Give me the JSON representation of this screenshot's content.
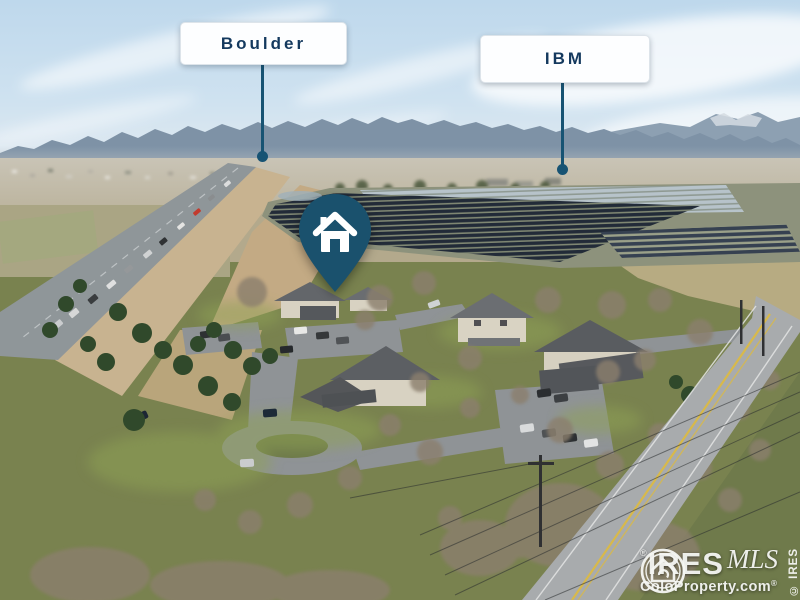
{
  "photo": {
    "callouts": [
      {
        "id": "boulder",
        "label": "Boulder"
      },
      {
        "id": "ibm",
        "label": "IBM"
      }
    ],
    "pin": {
      "icon": "house-icon",
      "color": "#1a516d"
    },
    "watermark": {
      "brand": "IRES",
      "script": "MLS",
      "registered": "®",
      "site": "ColoProperty.com",
      "vertical": "© IRES"
    },
    "colors": {
      "callout_text": "#14395e",
      "callout_line": "#175373",
      "callout_bg": "#fdfeff",
      "sky": "#c3dbee",
      "mountains": "#7e92a6",
      "solar_panels": "#222b38",
      "grass": "#79824f"
    }
  }
}
